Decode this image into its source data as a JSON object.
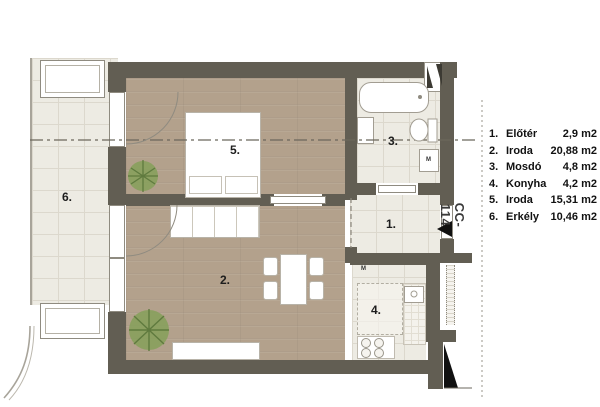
{
  "plan": {
    "unit_label": "CC-114",
    "legend": [
      {
        "num": "1.",
        "name": "Előtér",
        "area": "2,9 m2"
      },
      {
        "num": "2.",
        "name": "Iroda",
        "area": "20,88 m2"
      },
      {
        "num": "3.",
        "name": "Mosdó",
        "area": "4,8 m2"
      },
      {
        "num": "4.",
        "name": "Konyha",
        "area": "4,2 m2"
      },
      {
        "num": "5.",
        "name": "Iroda",
        "area": "15,31 m2"
      },
      {
        "num": "6.",
        "name": "Erkély",
        "area": "10,46 m2"
      }
    ],
    "room_labels": {
      "entry": "1.",
      "living": "2.",
      "bath": "3.",
      "kitchen": "4.",
      "office": "5.",
      "balcony": "6."
    },
    "appliance_labels": {
      "washer": "M",
      "kitchen_m": "M"
    },
    "colors": {
      "wall": "#625e53",
      "wood_floor": "#b3a18c",
      "tile_floor": "#edebe3",
      "plant_green": "#87a05c",
      "marker_black": "#111111"
    }
  }
}
